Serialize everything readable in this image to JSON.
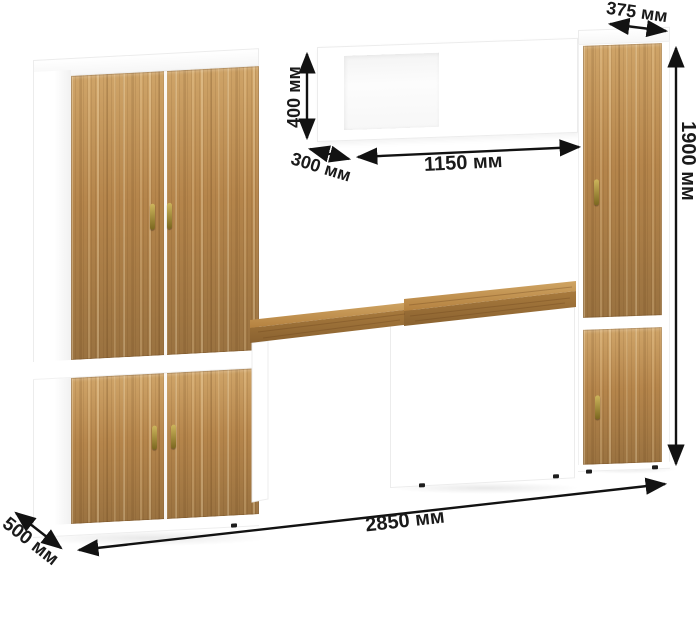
{
  "dimension_labels": {
    "top_depth": "375 мм",
    "wall_shelf_height": "400 мм",
    "wall_shelf_depth": "300 мм",
    "wall_shelf_width": "1150 мм",
    "total_height": "1900 мм",
    "total_width": "2850 мм",
    "base_depth": "500 мм"
  },
  "colors": {
    "background": "#ffffff",
    "carcass": "#ffffff",
    "carcass_edge": "#ececec",
    "wood_light": "#cfa468",
    "wood_base": "#b5854b",
    "wood_dark": "#9a7240",
    "handle_light": "#cdb55c",
    "handle_dark": "#7a661f",
    "dimension_line": "#121212",
    "dimension_text": "#1a1a1a",
    "foot": "#1d1d1d"
  }
}
